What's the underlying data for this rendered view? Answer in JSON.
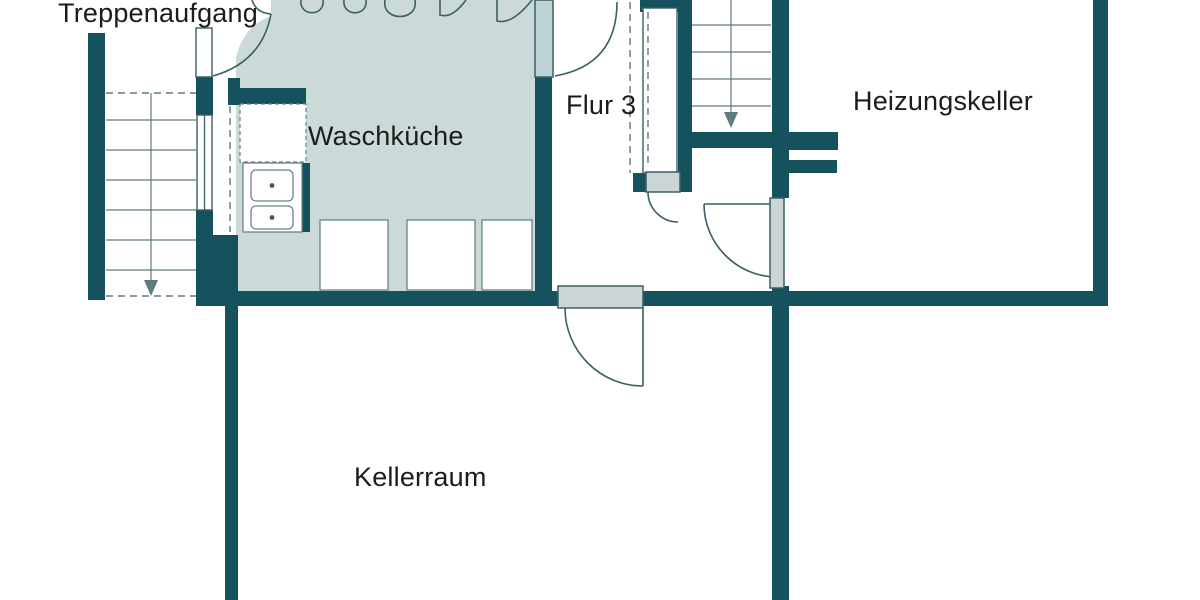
{
  "title": "Kellergeschoss Grundriss",
  "rooms": {
    "stairwell": {
      "label": "Treppenaufgang"
    },
    "laundry": {
      "label": "Waschküche"
    },
    "hall": {
      "label": "Flur 3"
    },
    "boiler": {
      "label": "Heizungskeller"
    },
    "cellar": {
      "label": "Kellerraum"
    }
  },
  "colors": {
    "wall": "#15525e",
    "floor": "#cbdad9",
    "door_leaf": "#ccd5d6",
    "door_leaf_accent": "#bed3d3",
    "line": "#3c5e64",
    "stair_line": "#5e7b80",
    "appliance_outline": "#6b8288",
    "text": "#1c1c1c",
    "background": "#ffffff"
  }
}
